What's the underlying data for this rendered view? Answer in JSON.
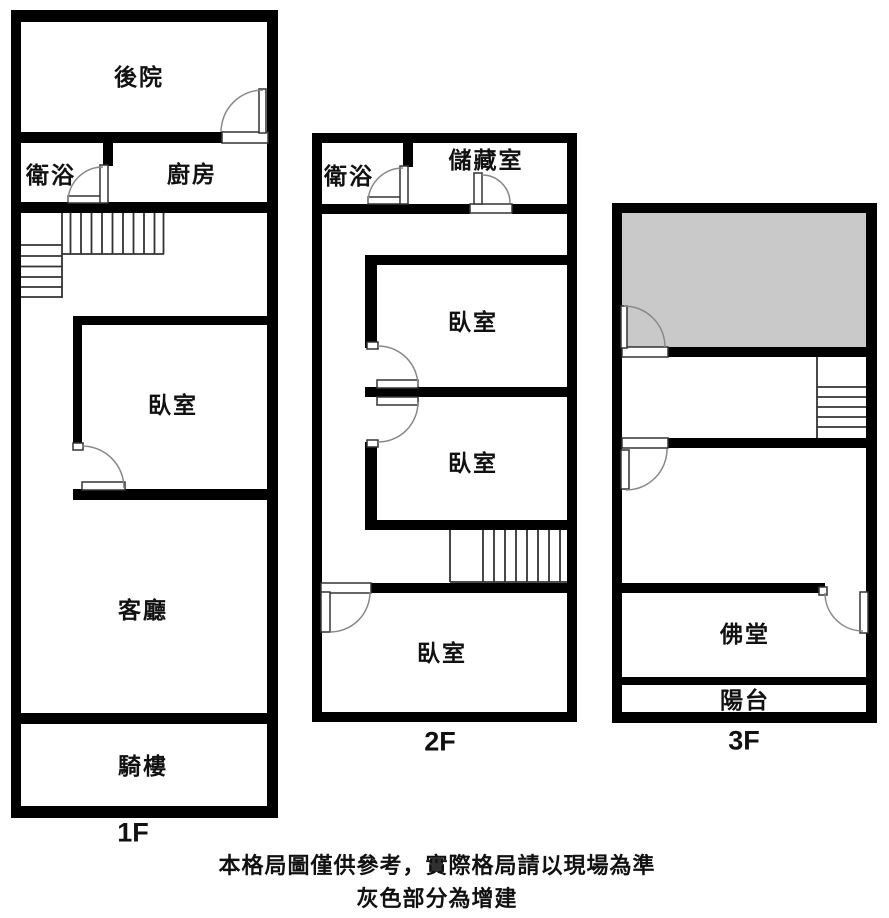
{
  "title": "floor-plan",
  "colors": {
    "wall": "#000000",
    "addition_fill": "#c9c9c9",
    "door_line": "#888888",
    "stair_line": "#333333",
    "text": "#111111",
    "background": "#ffffff"
  },
  "floors": [
    {
      "id": "1f",
      "label": "1F",
      "rooms": [
        {
          "key": "backyard",
          "label": "後院"
        },
        {
          "key": "bathroom",
          "label": "衛浴"
        },
        {
          "key": "kitchen",
          "label": "廚房"
        },
        {
          "key": "bedroom",
          "label": "臥室"
        },
        {
          "key": "living-room",
          "label": "客廳"
        },
        {
          "key": "arcade",
          "label": "騎樓"
        }
      ]
    },
    {
      "id": "2f",
      "label": "2F",
      "rooms": [
        {
          "key": "bathroom",
          "label": "衛浴"
        },
        {
          "key": "storage",
          "label": "儲藏室"
        },
        {
          "key": "bedroom-1",
          "label": "臥室"
        },
        {
          "key": "bedroom-2",
          "label": "臥室"
        },
        {
          "key": "bedroom-3",
          "label": "臥室"
        }
      ]
    },
    {
      "id": "3f",
      "label": "3F",
      "rooms": [
        {
          "key": "buddhist-hall",
          "label": "佛堂"
        },
        {
          "key": "balcony",
          "label": "陽台"
        }
      ]
    }
  ],
  "footer": {
    "line1": "本格局圖僅供參考，實際格局請以現場為準",
    "line2": "灰色部分為增建"
  }
}
